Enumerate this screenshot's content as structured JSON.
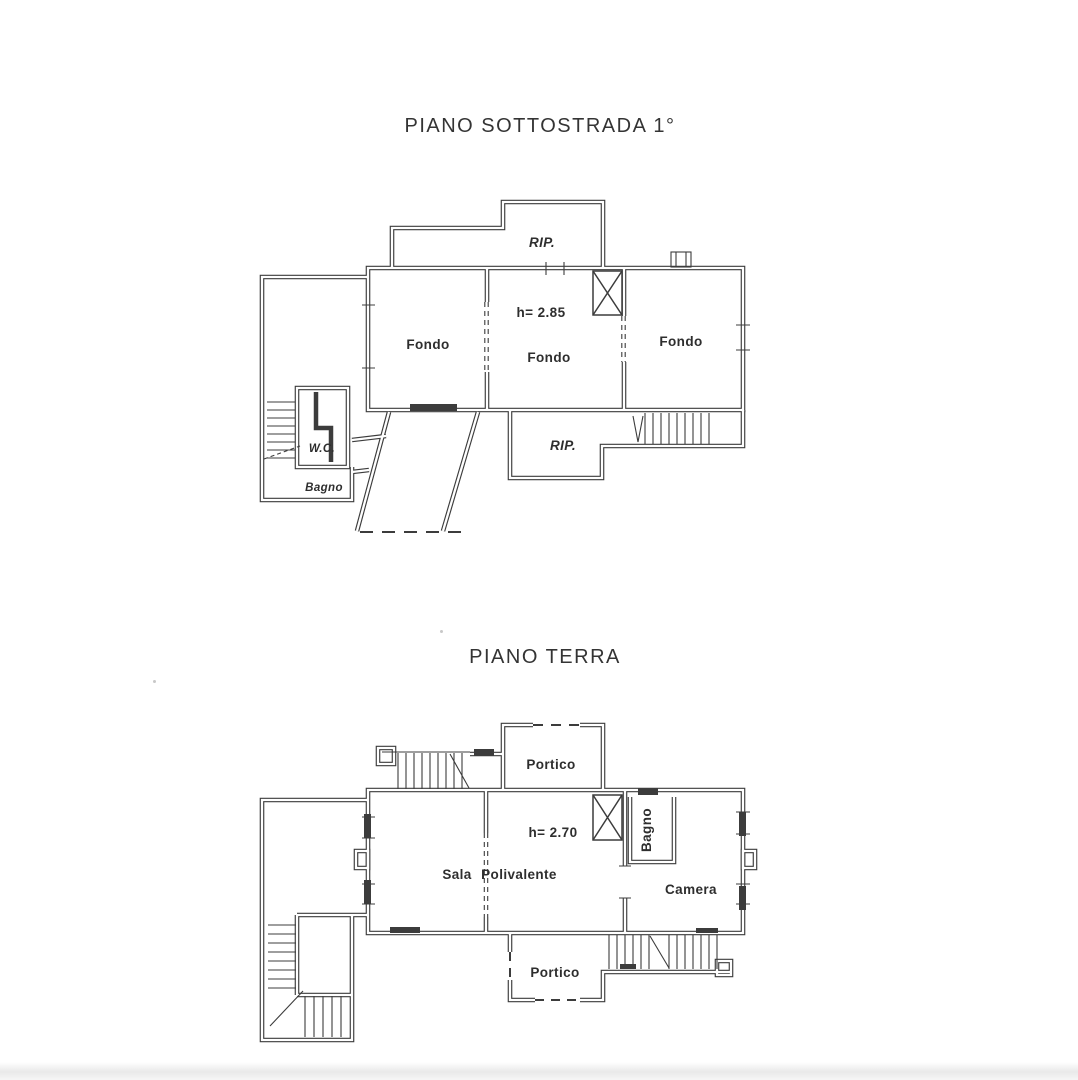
{
  "colors": {
    "ink": "#3c3c3c",
    "paper": "#ffffff",
    "shadow": "#e9e9e9"
  },
  "plans": [
    {
      "title": "PIANO SOTTOSTRADA 1°",
      "height_note": "h= 2.85",
      "rooms": {
        "rip_top": "RIP.",
        "fondo_left": "Fondo",
        "fondo_center": "Fondo",
        "fondo_right": "Fondo",
        "wc": "W.C.",
        "bagno": "Bagno",
        "rip_bottom": "RIP."
      }
    },
    {
      "title": "PIANO TERRA",
      "height_note": "h= 2.70",
      "rooms": {
        "portico_top": "Portico",
        "sala": "Sala",
        "polivalente": "Polivalente",
        "bagno": "Bagno",
        "camera": "Camera",
        "portico_bottom": "Portico"
      }
    }
  ]
}
